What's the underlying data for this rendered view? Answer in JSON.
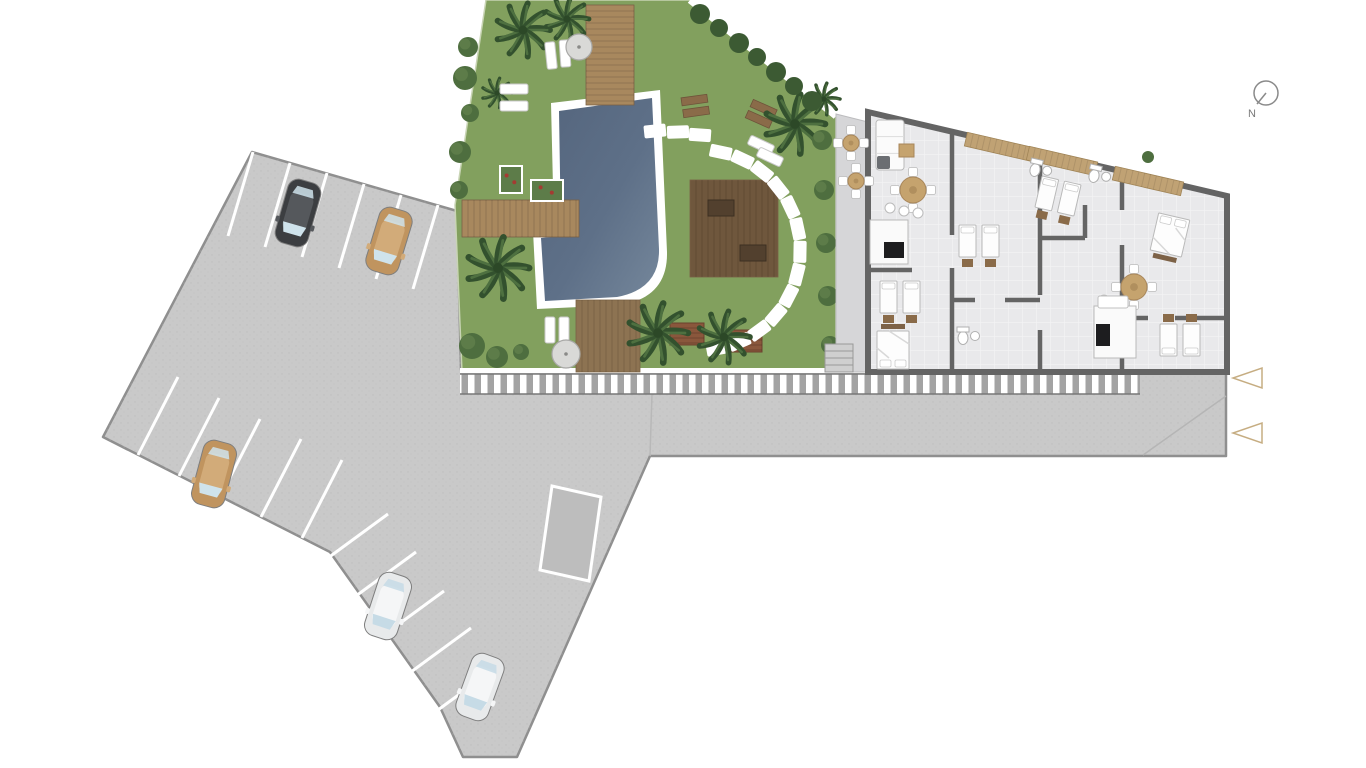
{
  "north": {
    "label": "N"
  },
  "colors": {
    "paved": "#c9c9c9",
    "paved_edge": "#8f8f8f",
    "grass": "#82a05e",
    "pool_deep": "#54657d",
    "pool_light": "#75879b",
    "rim": "#ffffff",
    "deck_light": "#a8885e",
    "deck_mid": "#8d7352",
    "deck_dark": "#6f573d",
    "palm": "#33512e",
    "bush": "#4e6e3f",
    "patio": "#d6d6d8",
    "floor": "#e9e9eb",
    "wall": "#646464",
    "stripe_bg": "#a3a3a3",
    "marker": "#c6ad82",
    "tan_wood": "#c5a36e"
  },
  "site": {
    "cars": [
      {
        "name": "car-black",
        "x": 298,
        "y": 213,
        "rot": 16,
        "body": "#3c3e41",
        "roof": "#55585c",
        "glass": "#cfe3ec"
      },
      {
        "name": "car-tan-top",
        "x": 389,
        "y": 241,
        "rot": 17,
        "body": "#c0945f",
        "roof": "#d2ab79",
        "glass": "#cfe3ec"
      },
      {
        "name": "car-tan-left",
        "x": 214,
        "y": 474,
        "rot": 15,
        "body": "#c0945f",
        "roof": "#d2ab79",
        "glass": "#cfe3ec"
      },
      {
        "name": "car-white-1",
        "x": 388,
        "y": 606,
        "rot": 18,
        "body": "#e8eaeb",
        "roof": "#f5f6f7",
        "glass": "#c6dbe6"
      },
      {
        "name": "car-white-2",
        "x": 480,
        "y": 687,
        "rot": 20,
        "body": "#e8eaeb",
        "roof": "#f5f6f7",
        "glass": "#c6dbe6"
      }
    ],
    "parking_lines": [
      [
        253,
        152,
        228,
        236
      ],
      [
        290,
        163,
        265,
        247
      ],
      [
        327,
        173,
        302,
        257
      ],
      [
        364,
        184,
        339,
        268
      ],
      [
        401,
        195,
        376,
        279
      ],
      [
        438,
        205,
        413,
        289
      ],
      [
        138,
        455,
        178,
        377
      ],
      [
        179,
        476,
        219,
        398
      ],
      [
        220,
        497,
        260,
        419
      ],
      [
        261,
        517,
        301,
        439
      ],
      [
        302,
        538,
        342,
        460
      ],
      [
        317,
        566,
        388,
        514
      ],
      [
        345,
        604,
        416,
        552
      ],
      [
        373,
        643,
        444,
        591
      ],
      [
        400,
        680,
        471,
        628
      ],
      [
        427,
        718,
        498,
        666
      ]
    ],
    "palms": [
      {
        "x": 523,
        "y": 30,
        "r": 27
      },
      {
        "x": 567,
        "y": 19,
        "r": 22
      },
      {
        "x": 497,
        "y": 93,
        "r": 15
      },
      {
        "x": 498,
        "y": 268,
        "r": 31
      },
      {
        "x": 658,
        "y": 333,
        "r": 30
      },
      {
        "x": 724,
        "y": 337,
        "r": 26
      },
      {
        "x": 795,
        "y": 124,
        "r": 30
      },
      {
        "x": 824,
        "y": 99,
        "r": 16
      }
    ],
    "bushes": [
      {
        "x": 468,
        "y": 47,
        "r": 10
      },
      {
        "x": 465,
        "y": 78,
        "r": 12
      },
      {
        "x": 470,
        "y": 113,
        "r": 9
      },
      {
        "x": 460,
        "y": 152,
        "r": 11
      },
      {
        "x": 459,
        "y": 190,
        "r": 9
      },
      {
        "x": 472,
        "y": 346,
        "r": 13
      },
      {
        "x": 497,
        "y": 357,
        "r": 11
      },
      {
        "x": 521,
        "y": 352,
        "r": 8
      },
      {
        "x": 822,
        "y": 140,
        "r": 10
      },
      {
        "x": 824,
        "y": 190,
        "r": 10
      },
      {
        "x": 826,
        "y": 243,
        "r": 10
      },
      {
        "x": 828,
        "y": 296,
        "r": 10
      },
      {
        "x": 830,
        "y": 345,
        "r": 9
      }
    ],
    "hedge_diag": [
      {
        "x": 700,
        "y": 14,
        "r": 10
      },
      {
        "x": 719,
        "y": 28,
        "r": 9
      },
      {
        "x": 739,
        "y": 43,
        "r": 10
      },
      {
        "x": 757,
        "y": 57,
        "r": 9
      },
      {
        "x": 776,
        "y": 72,
        "r": 10
      },
      {
        "x": 794,
        "y": 86,
        "r": 9
      },
      {
        "x": 812,
        "y": 101,
        "r": 10
      }
    ],
    "plants_small": [
      {
        "x": 962,
        "y": 140,
        "r": 7
      },
      {
        "x": 1148,
        "y": 157,
        "r": 6
      },
      {
        "x": 1222,
        "y": 213,
        "r": 7
      },
      {
        "x": 1223,
        "y": 233,
        "r": 6
      }
    ],
    "decks": [
      {
        "x": 586,
        "y": 5,
        "w": 48,
        "h": 100,
        "plank": "h",
        "color": "#a8885e"
      },
      {
        "x": 462,
        "y": 200,
        "w": 117,
        "h": 37,
        "plank": "v",
        "color": "#a8885e"
      },
      {
        "x": 576,
        "y": 300,
        "w": 64,
        "h": 72,
        "plank": "v",
        "color": "#8d7352"
      },
      {
        "x": 690,
        "y": 180,
        "w": 88,
        "h": 97,
        "plank": "v",
        "color": "#6f573d"
      }
    ],
    "deck_tables": [
      {
        "x": 708,
        "y": 200,
        "w": 26,
        "h": 16
      },
      {
        "x": 740,
        "y": 245,
        "w": 26,
        "h": 16
      }
    ],
    "platforms": [
      {
        "x": 670,
        "y": 323,
        "w": 34,
        "h": 22
      },
      {
        "x": 728,
        "y": 330,
        "w": 34,
        "h": 22
      }
    ],
    "benches": [
      {
        "x": 695,
        "y": 104,
        "rot": -8
      },
      {
        "x": 762,
        "y": 112,
        "rot": 24
      }
    ],
    "loungers": [
      {
        "x": 546,
        "y": 42,
        "w": 10,
        "h": 27,
        "rot": -6
      },
      {
        "x": 560,
        "y": 40,
        "w": 10,
        "h": 27,
        "rot": -4
      },
      {
        "x": 500,
        "y": 84,
        "w": 28,
        "h": 10,
        "rot": 0
      },
      {
        "x": 500,
        "y": 101,
        "w": 28,
        "h": 10,
        "rot": 0
      },
      {
        "x": 545,
        "y": 317,
        "w": 10,
        "h": 26,
        "rot": 0
      },
      {
        "x": 559,
        "y": 317,
        "w": 10,
        "h": 26,
        "rot": 0
      },
      {
        "x": 748,
        "y": 140,
        "w": 26,
        "h": 10,
        "rot": 25
      },
      {
        "x": 757,
        "y": 152,
        "w": 26,
        "h": 10,
        "rot": 25
      }
    ],
    "umbrellas": [
      {
        "x": 579,
        "y": 47,
        "r": 13
      },
      {
        "x": 566,
        "y": 354,
        "r": 14
      }
    ],
    "stones_arc": {
      "cx": 700,
      "cy": 250,
      "r": 100,
      "a0": -78,
      "a1": 80,
      "n": 13,
      "w": 22,
      "h": 13
    },
    "stones_extra": [
      {
        "x": 655,
        "y": 131,
        "rot": -6
      },
      {
        "x": 678,
        "y": 132,
        "rot": -2
      },
      {
        "x": 700,
        "y": 135,
        "rot": 4
      }
    ],
    "planters": [
      {
        "x": 500,
        "y": 166,
        "w": 22,
        "h": 27
      },
      {
        "x": 531,
        "y": 180,
        "w": 32,
        "h": 21
      }
    ],
    "markers": [
      {
        "x": 1247,
        "y": 378
      },
      {
        "x": 1247,
        "y": 433
      }
    ]
  },
  "building": {
    "walls": [
      [
        952,
        132,
        952,
        235
      ],
      [
        952,
        268,
        952,
        372
      ],
      [
        1040,
        152,
        1040,
        295
      ],
      [
        1040,
        330,
        1040,
        372
      ],
      [
        1122,
        171,
        1122,
        210
      ],
      [
        1122,
        245,
        1122,
        372
      ],
      [
        952,
        300,
        975,
        300
      ],
      [
        1005,
        300,
        1040,
        300
      ],
      [
        1122,
        318,
        1148,
        318
      ],
      [
        1175,
        318,
        1227,
        318
      ],
      [
        1040,
        238,
        1085,
        238
      ],
      [
        1085,
        205,
        1085,
        238
      ],
      [
        868,
        270,
        912,
        270
      ]
    ],
    "wood_strips": [
      {
        "x": 1000,
        "y": 147
      },
      {
        "x": 1062,
        "y": 161
      },
      {
        "x": 1148,
        "y": 181
      }
    ],
    "beds_double": [
      {
        "x": 893,
        "y": 350,
        "rot": 180
      },
      {
        "x": 1170,
        "y": 235,
        "rot": 13
      }
    ],
    "beds_twin": [
      {
        "x": 900,
        "y": 297,
        "rot": 0
      },
      {
        "x": 979,
        "y": 241,
        "rot": 0
      },
      {
        "x": 1058,
        "y": 196,
        "rot": 13
      },
      {
        "x": 1180,
        "y": 340,
        "rot": 180
      }
    ],
    "tables_round": [
      {
        "x": 913,
        "y": 190,
        "r": 13
      },
      {
        "x": 1134,
        "y": 287,
        "r": 13
      }
    ],
    "terrace_tables": [
      {
        "x": 851,
        "y": 143,
        "r": 8
      },
      {
        "x": 856,
        "y": 181,
        "r": 8
      }
    ],
    "kitchens": [
      {
        "x": 870,
        "y": 220,
        "w": 38,
        "h": 44,
        "stove": [
          884,
          242,
          20,
          16
        ],
        "stools": [
          [
            890,
            208
          ],
          [
            904,
            211
          ],
          [
            918,
            213
          ]
        ]
      },
      {
        "x": 1094,
        "y": 306,
        "w": 42,
        "h": 52,
        "stove": [
          1096,
          324,
          14,
          22
        ],
        "stools": [
          [
            1104,
            300
          ],
          [
            1117,
            303
          ]
        ]
      }
    ],
    "baths": [
      {
        "x": 1094,
        "y": 176,
        "rot": 13
      },
      {
        "x": 963,
        "y": 338,
        "rot": 0
      },
      {
        "x": 1035,
        "y": 170,
        "rot": 13
      }
    ],
    "sofa": {
      "x": 876,
      "y": 120,
      "w": 28,
      "h": 50
    },
    "armchair": {
      "x": 877,
      "y": 156,
      "w": 13,
      "h": 13
    },
    "coffee_table": {
      "x": 899,
      "y": 144,
      "w": 15,
      "h": 13
    },
    "white_rects": [
      {
        "x": 1098,
        "y": 296,
        "w": 30,
        "h": 12
      }
    ]
  }
}
